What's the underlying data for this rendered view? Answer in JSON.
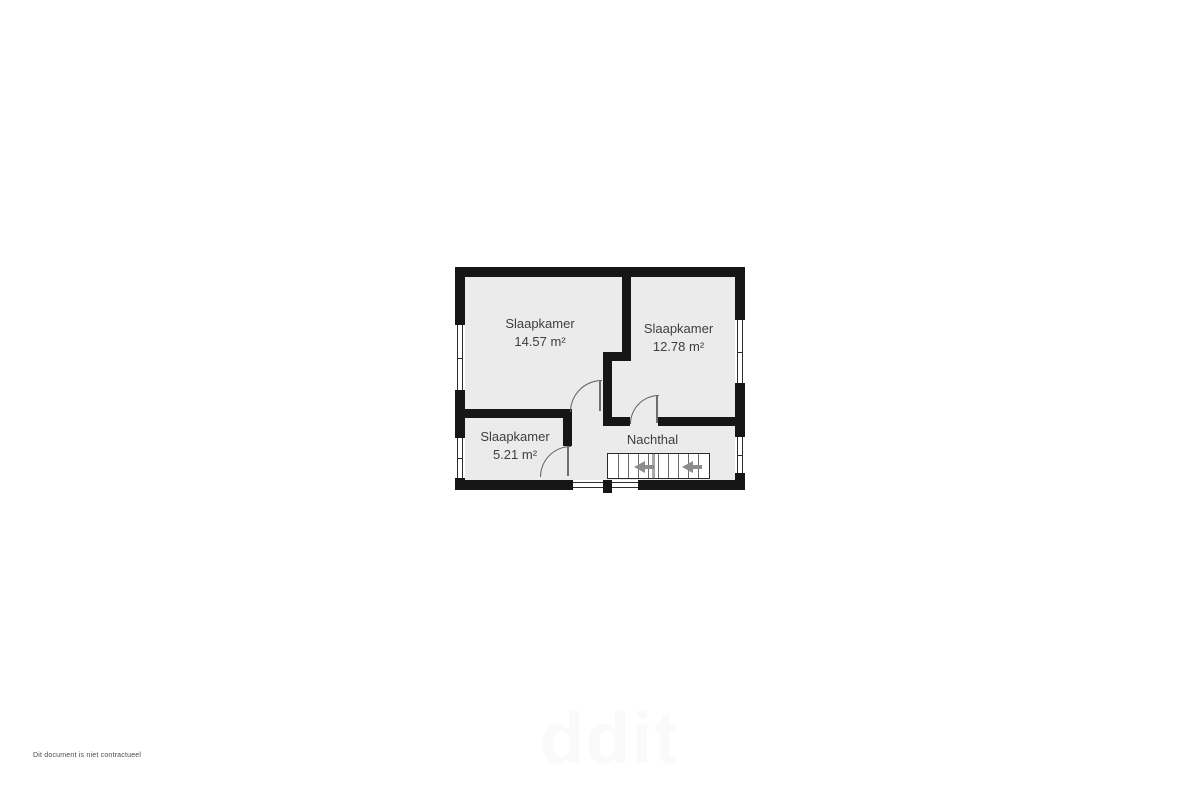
{
  "page": {
    "disclaimer": "Dit document is niet contractueel",
    "watermark": "ddit"
  },
  "floorplan": {
    "type": "floor-plan",
    "rooms": [
      {
        "name": "Slaapkamer",
        "area": "14.57 m²"
      },
      {
        "name": "Slaapkamer",
        "area": "12.78 m²"
      },
      {
        "name": "Slaapkamer",
        "area": "5.21 m²"
      },
      {
        "name": "Nachthal",
        "area": ""
      }
    ],
    "icons": {
      "stair_arrows": "left-arrow (down direction)"
    },
    "colors": {
      "wall": "#161616",
      "floor": "#ebebeb",
      "text": "#3e3e3e",
      "stair_arrow": "#8c8c8c"
    }
  }
}
